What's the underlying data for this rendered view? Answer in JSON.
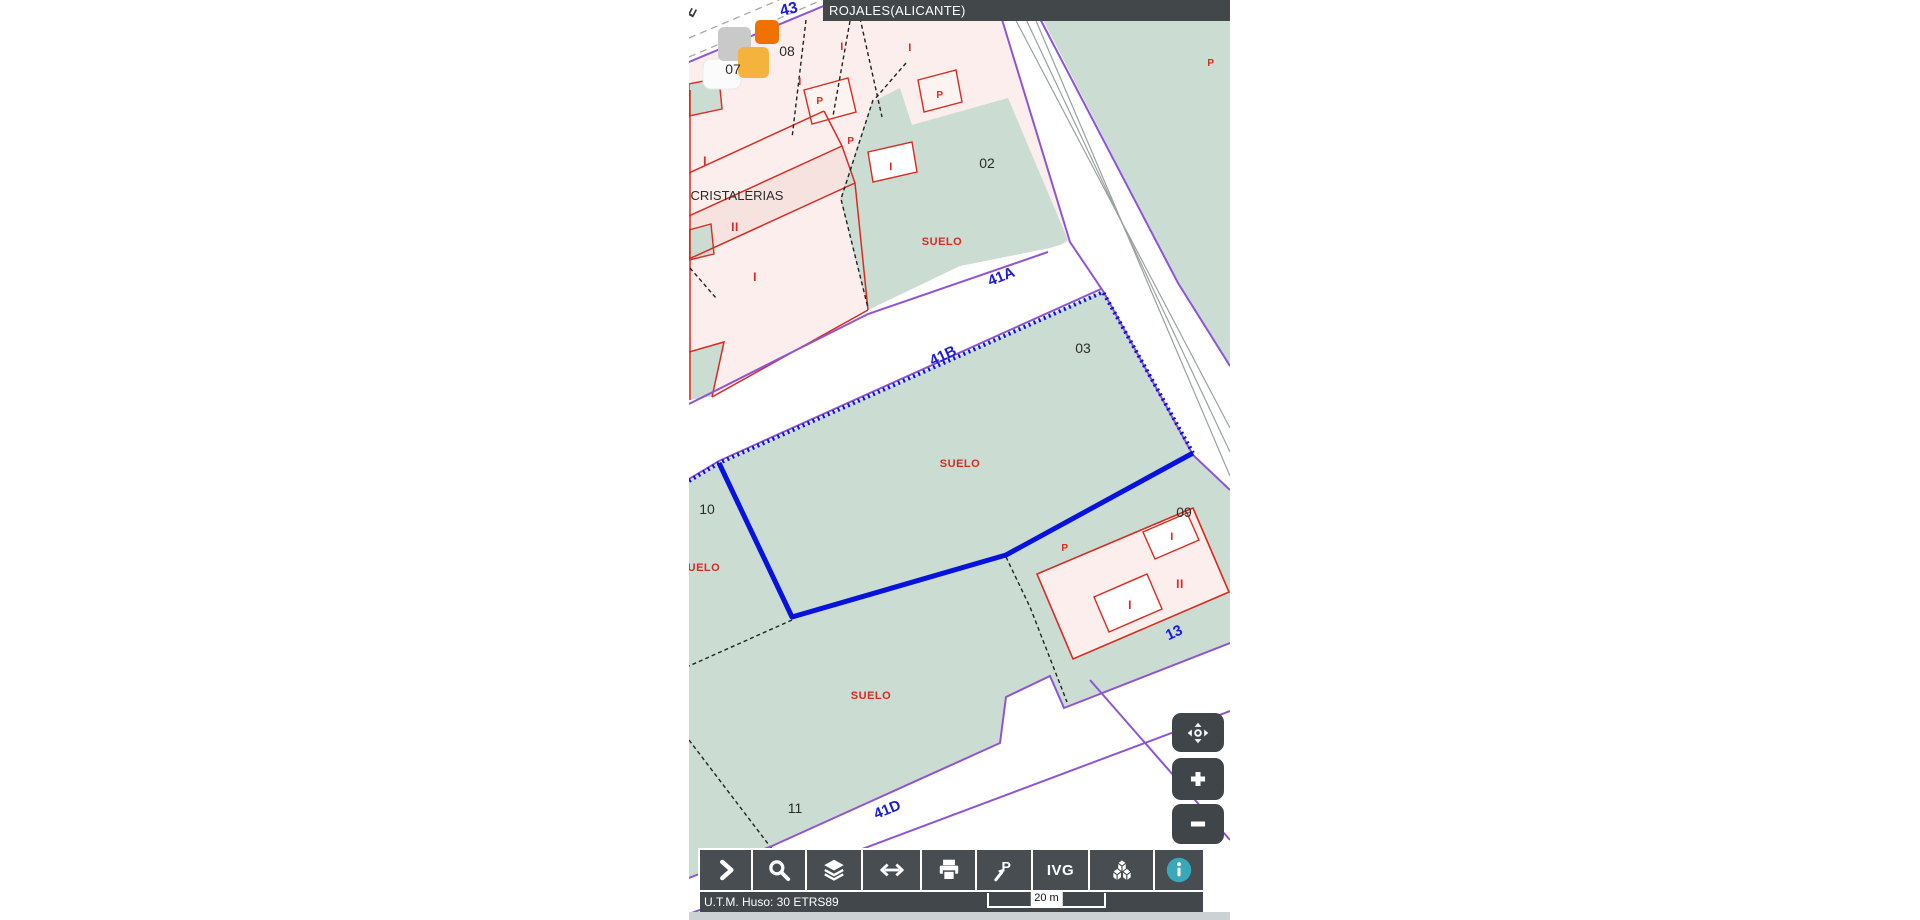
{
  "title_bar": {
    "text": "ROJALES(ALICANTE)"
  },
  "colors": {
    "parcel_green": "#cbdcd3",
    "parcel_pink": "#fbeeec",
    "parcel_pink_dark": "#f6e3df",
    "cadastre_red": "#d92b1f",
    "street_purple": "#8d55d6",
    "selection_blue": "#0712df",
    "street_label_blue": "#1b1bd8",
    "ui_dark": "#42474a",
    "info_teal": "#3aa8bb",
    "tile_orange": "#ef7100",
    "tile_amber": "#f4b33d",
    "tile_gray": "#c9c9c9"
  },
  "map": {
    "labels": [
      {
        "n": "street-letter-e",
        "t": "E",
        "x": 695,
        "y": 14,
        "s": 15,
        "c": "lbl-gray",
        "r": -62
      },
      {
        "n": "street-label-43",
        "t": "43",
        "x": 790,
        "y": 14,
        "s": 16,
        "c": "lbl-blue",
        "r": -14
      },
      {
        "n": "parcel-number-07",
        "t": "07",
        "x": 733,
        "y": 74,
        "s": 14,
        "c": "lbl-black",
        "r": 0
      },
      {
        "n": "parcel-number-08",
        "t": "08",
        "x": 787,
        "y": 56,
        "s": 14,
        "c": "lbl-black",
        "r": 0
      },
      {
        "n": "floors-label",
        "t": "I",
        "x": 800,
        "y": 85,
        "s": 11,
        "c": "lbl-red",
        "r": 0
      },
      {
        "n": "patio-label",
        "t": "P",
        "x": 820,
        "y": 104,
        "s": 10,
        "c": "lbl-red",
        "r": 0
      },
      {
        "n": "floors-label",
        "t": "I",
        "x": 842,
        "y": 50,
        "s": 11,
        "c": "lbl-red",
        "r": 0
      },
      {
        "n": "floors-label",
        "t": "I",
        "x": 910,
        "y": 51,
        "s": 11,
        "c": "lbl-red",
        "r": 0
      },
      {
        "n": "patio-label",
        "t": "P",
        "x": 940,
        "y": 98,
        "s": 10,
        "c": "lbl-red",
        "r": 0
      },
      {
        "n": "patio-label",
        "t": "P",
        "x": 851,
        "y": 144,
        "s": 10,
        "c": "lbl-red",
        "r": 0
      },
      {
        "n": "floors-label",
        "t": "I",
        "x": 891,
        "y": 170,
        "s": 11,
        "c": "lbl-red",
        "r": 0
      },
      {
        "n": "floors-label",
        "t": "I",
        "x": 705,
        "y": 165,
        "s": 12,
        "c": "lbl-red",
        "r": 0
      },
      {
        "n": "street-name-cristalerias",
        "t": "CRISTALERIAS",
        "x": 737,
        "y": 200,
        "s": 13,
        "c": "lbl-black",
        "r": 0
      },
      {
        "n": "floors-label",
        "t": "II",
        "x": 735,
        "y": 231,
        "s": 12,
        "c": "lbl-red",
        "r": 0
      },
      {
        "n": "floors-label",
        "t": "I",
        "x": 755,
        "y": 281,
        "s": 12,
        "c": "lbl-red",
        "r": 0
      },
      {
        "n": "parcel-number-02",
        "t": "02",
        "x": 987,
        "y": 168,
        "s": 14,
        "c": "lbl-black",
        "r": 0
      },
      {
        "n": "suelo-label",
        "t": "SUELO",
        "x": 942,
        "y": 245,
        "s": 11,
        "c": "lbl-red",
        "r": 0
      },
      {
        "n": "patio-label",
        "t": "P",
        "x": 1211,
        "y": 66,
        "s": 10,
        "c": "lbl-red",
        "r": 0
      },
      {
        "n": "street-label-41a",
        "t": "41A",
        "x": 1003,
        "y": 281,
        "s": 15,
        "c": "lbl-blue",
        "r": -22
      },
      {
        "n": "street-label-41b",
        "t": "41B",
        "x": 945,
        "y": 360,
        "s": 15,
        "c": "lbl-blue",
        "r": -25
      },
      {
        "n": "parcel-number-03",
        "t": "03",
        "x": 1083,
        "y": 353,
        "s": 14,
        "c": "lbl-black",
        "r": 0
      },
      {
        "n": "suelo-label",
        "t": "SUELO",
        "x": 960,
        "y": 467,
        "s": 11,
        "c": "lbl-red",
        "r": 0
      },
      {
        "n": "parcel-number-10",
        "t": "10",
        "x": 707,
        "y": 514,
        "s": 14,
        "c": "lbl-black",
        "r": 0
      },
      {
        "n": "suelo-label",
        "t": "SUELO",
        "x": 700,
        "y": 571,
        "s": 11,
        "c": "lbl-red",
        "r": 0
      },
      {
        "n": "parcel-number-09",
        "t": "09",
        "x": 1184,
        "y": 517,
        "s": 14,
        "c": "lbl-black",
        "r": 0
      },
      {
        "n": "patio-label",
        "t": "P",
        "x": 1065,
        "y": 551,
        "s": 10,
        "c": "lbl-red",
        "r": 0
      },
      {
        "n": "floors-label",
        "t": "I",
        "x": 1172,
        "y": 540,
        "s": 11,
        "c": "lbl-red",
        "r": 0
      },
      {
        "n": "floors-label",
        "t": "II",
        "x": 1180,
        "y": 588,
        "s": 12,
        "c": "lbl-red",
        "r": 0
      },
      {
        "n": "floors-label",
        "t": "I",
        "x": 1130,
        "y": 609,
        "s": 12,
        "c": "lbl-red",
        "r": 0
      },
      {
        "n": "street-label-13",
        "t": "13",
        "x": 1176,
        "y": 637,
        "s": 15,
        "c": "lbl-blue",
        "r": -25
      },
      {
        "n": "suelo-label",
        "t": "SUELO",
        "x": 871,
        "y": 699,
        "s": 11,
        "c": "lbl-red",
        "r": 0
      },
      {
        "n": "parcel-number-11",
        "t": "11",
        "x": 795,
        "y": 813,
        "s": 14,
        "c": "lbl-black",
        "r": 0
      },
      {
        "n": "street-label-41d",
        "t": "41D",
        "x": 889,
        "y": 814,
        "s": 15,
        "c": "lbl-blue",
        "r": -22
      },
      {
        "n": "street-label-zirconita",
        "t": "ZIRCONITA",
        "x": 757,
        "y": 883,
        "s": 15,
        "c": "lbl-blue",
        "r": -33
      }
    ]
  },
  "toolbar": {
    "buttons": [
      {
        "name": "expand-panel",
        "icon": "chevron-right",
        "w": 51
      },
      {
        "name": "search",
        "icon": "search",
        "w": 52
      },
      {
        "name": "layers",
        "icon": "layers",
        "w": 54
      },
      {
        "name": "measure",
        "icon": "arrows-h",
        "w": 57
      },
      {
        "name": "print",
        "icon": "printer",
        "w": 53
      },
      {
        "name": "parcel-point",
        "icon": "pointer-p",
        "w": 54,
        "icon_text": "P"
      },
      {
        "name": "ivg",
        "icon": "text",
        "w": 55,
        "label": "IVG"
      },
      {
        "name": "view-3d",
        "icon": "cubes",
        "w": 63
      },
      {
        "name": "info",
        "icon": "info",
        "w": 48,
        "icon_text": "i"
      }
    ]
  },
  "zoom_controls": {
    "pan": "pan",
    "zoom_in": "+",
    "zoom_out": "-"
  },
  "status_bar": {
    "datum_text": "U.T.M. Huso: 30 ETRS89",
    "scale_label": "20 m"
  }
}
